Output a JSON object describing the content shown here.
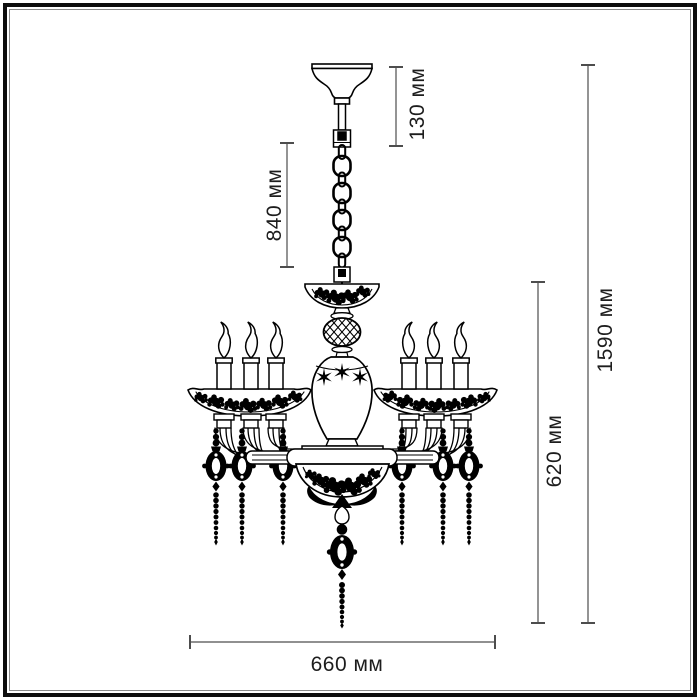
{
  "drawing": {
    "subject": "chandelier technical drawing",
    "lamp_count": 6,
    "pendant_count": 7
  },
  "colors": {
    "drawing_line": "#000000",
    "dimension_line": "#4d4d4d",
    "label_text": "#1d1d1d",
    "background": "#ffffff"
  },
  "dimensions": {
    "canopy_section": "130 мм",
    "chain_section": "840 мм",
    "overall_height": "1590 мм",
    "body_height": "620 мм",
    "overall_width": "660 мм"
  }
}
